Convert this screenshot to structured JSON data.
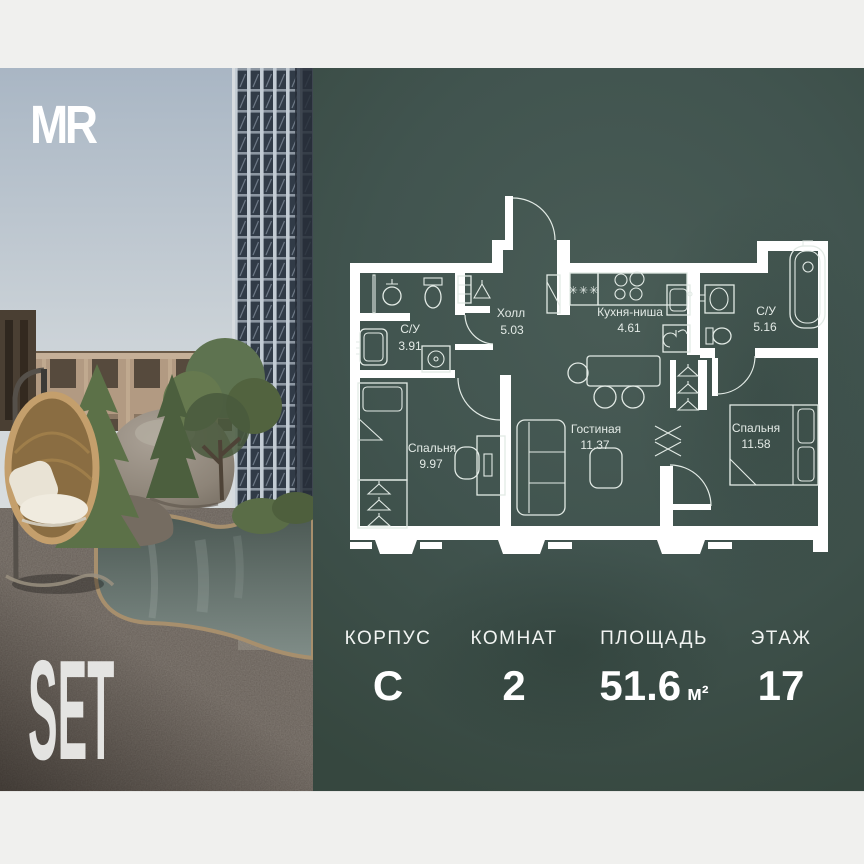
{
  "brand": {
    "logo_text": "MR",
    "project_name": "SET"
  },
  "floor_plan": {
    "rooms": [
      {
        "name": "С/У",
        "area": "3.91"
      },
      {
        "name": "Холл",
        "area": "5.03"
      },
      {
        "name": "Кухня-ниша",
        "area": "4.61"
      },
      {
        "name": "С/У",
        "area": "5.16"
      },
      {
        "name": "Спальня",
        "area": "9.97"
      },
      {
        "name": "Гостиная",
        "area": "11.37"
      },
      {
        "name": "Спальня",
        "area": "11.58"
      }
    ],
    "freezer_marks": "✳✳✳"
  },
  "stats": [
    {
      "label": "КОРПУС",
      "value": "C",
      "unit": ""
    },
    {
      "label": "КОМНАТ",
      "value": "2",
      "unit": ""
    },
    {
      "label": "ПЛОЩАДЬ",
      "value": "51.6",
      "unit": "м²"
    },
    {
      "label": "ЭТАЖ",
      "value": "17",
      "unit": ""
    }
  ],
  "colors": {
    "panel_green": "#41544f",
    "band_white": "#f0f0ee",
    "plan_walls": "#ffffff",
    "rattan": "#c09a66",
    "water": "#5f6e6b"
  }
}
